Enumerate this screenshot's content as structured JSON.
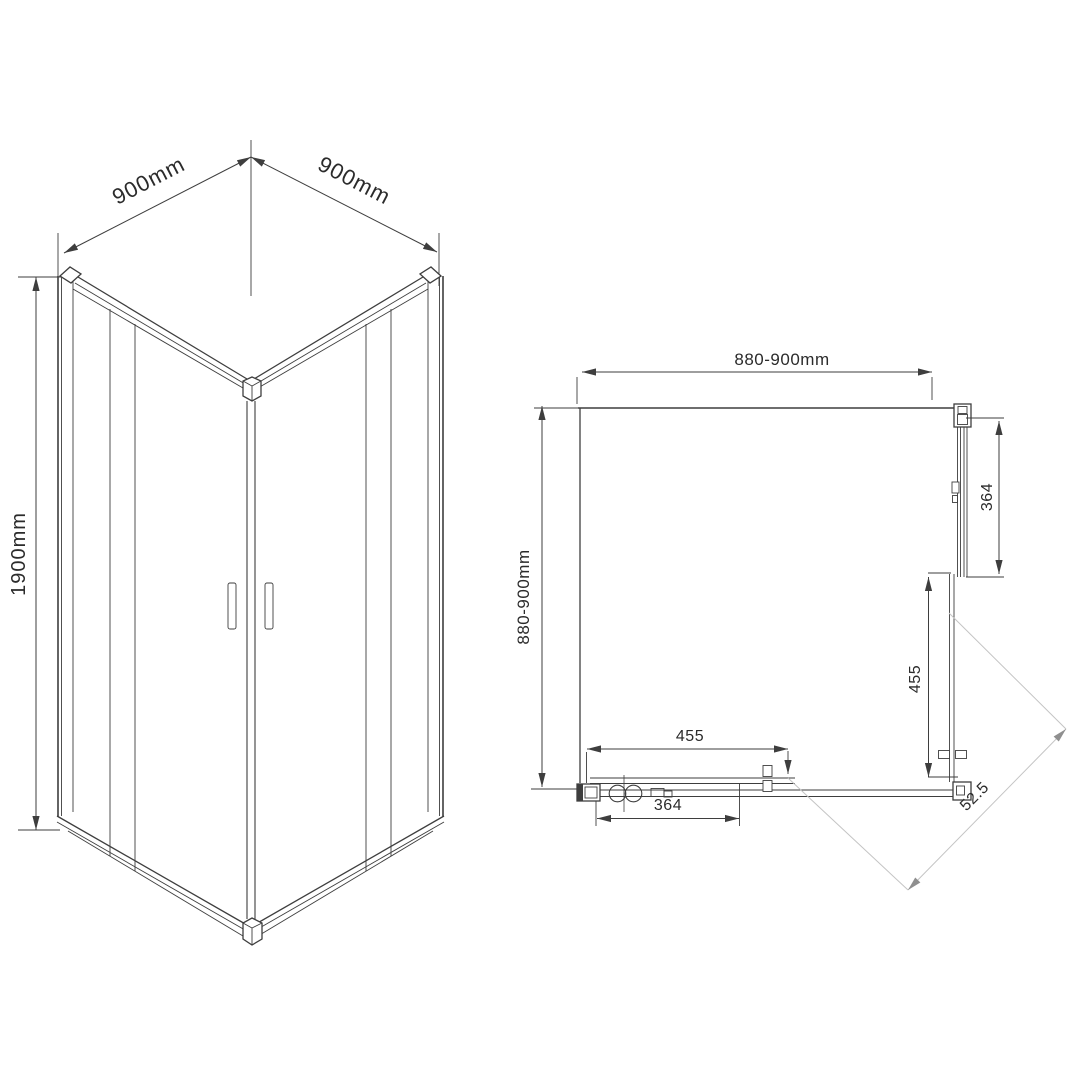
{
  "colors": {
    "paper": "#ffffff",
    "ink": "#3e3e3e",
    "text": "#2b2b2b",
    "lightline": "#c4c4c4",
    "grayarrow": "#8f8f8f"
  },
  "isometric_view": {
    "width_left_label": "900mm",
    "width_right_label": "900mm",
    "height_label": "1900mm"
  },
  "plan_view": {
    "top_width_label": "880-900mm",
    "side_depth_label": "880-900mm",
    "right_fixed_panel_label": "364",
    "right_door_label": "455",
    "bottom_door_label": "455",
    "bottom_fixed_panel_label": "364",
    "diagonal_label": "52.5"
  }
}
